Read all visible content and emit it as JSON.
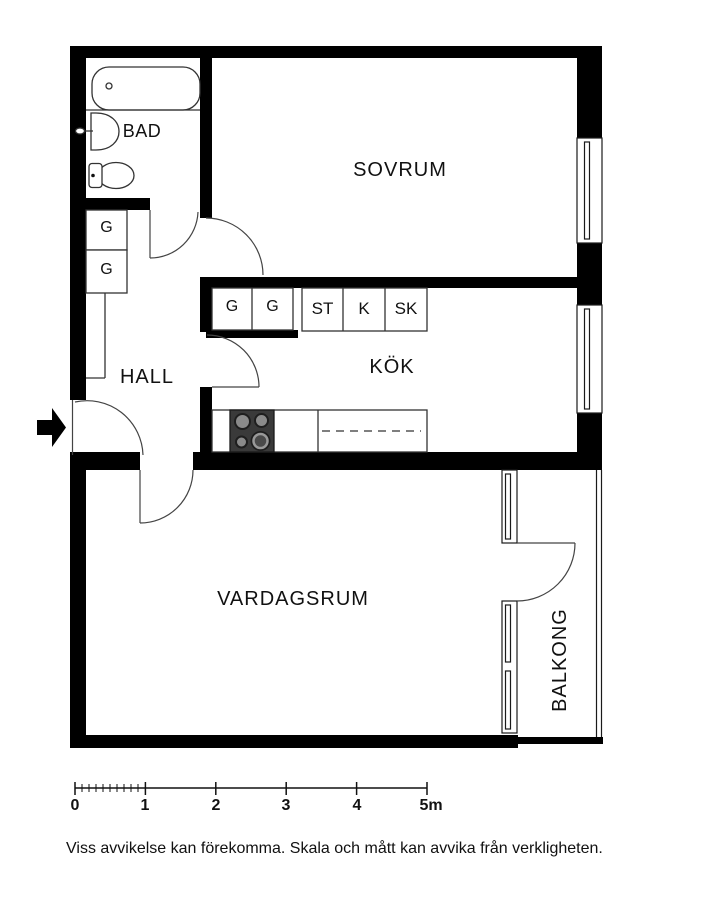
{
  "rooms": {
    "bathroom": "BAD",
    "bedroom": "SOVRUM",
    "hall": "HALL",
    "kitchen": "KÖK",
    "living_room": "VARDAGSRUM",
    "balcony": "BALKONG"
  },
  "closets": {
    "hall_wardrobes": [
      "G",
      "G"
    ],
    "kitchen_wardrobes": [
      "G",
      "G"
    ],
    "kitchen_units": [
      "ST",
      "K",
      "SK"
    ]
  },
  "scale_bar": {
    "tick_labels": [
      "0",
      "1",
      "2",
      "3",
      "4",
      "5m"
    ]
  },
  "disclaimer": "Viss avvikelse kan förekomma. Skala och mått kan avvika från verkligheten.",
  "colors": {
    "wall": "#000000",
    "background": "#ffffff",
    "line": "#1a1a1a",
    "stove_body": "#3a3a3a",
    "burner": "#8a8a8a"
  },
  "icons": {
    "entrance_arrow": "solid-right-arrow"
  }
}
